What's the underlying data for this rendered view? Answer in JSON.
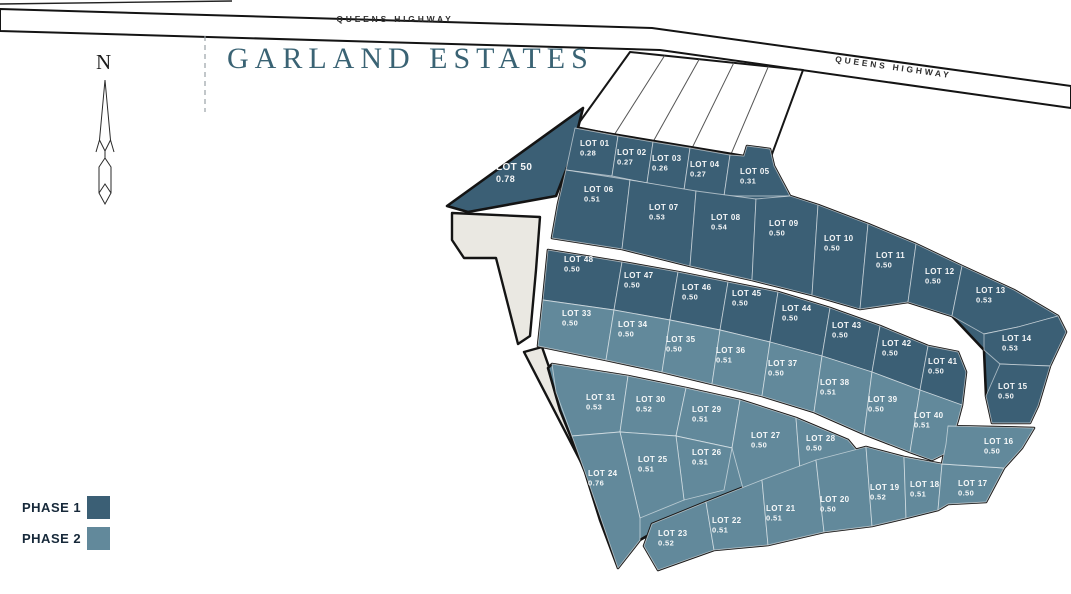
{
  "page": {
    "title": "GARLAND ESTATES"
  },
  "highway": {
    "name": "QUEENS HIGHWAY"
  },
  "compass": {
    "north_label": "N"
  },
  "legend": {
    "items": [
      {
        "label": "PHASE 1",
        "color": "#3B5F75"
      },
      {
        "label": "PHASE 2",
        "color": "#62899B"
      }
    ]
  },
  "map": {
    "colors": {
      "phase1": "#3B5F75",
      "phase2": "#62899B",
      "parcel_beige": "#EAE8E2",
      "road_fill": "#FFFFFF",
      "outline": "#141414",
      "strip_divider": "#555555",
      "lot_divider": "rgba(255,255,255,0.55)",
      "label": "#FFFFFF",
      "dashed": "#9AA2A6",
      "highway_text": "#2E2E2E"
    },
    "road_band": "0,9 652,28 1071,86 1071,108 660,50 0,31",
    "top_line": {
      "x1": 0,
      "y1": 4,
      "x2": 232,
      "y2": 1
    },
    "dashed_line": {
      "x": 205,
      "y1": 36,
      "y2": 112
    },
    "strips": {
      "pts": "630,52 803,70 768,165 576,127",
      "dividers": 4
    },
    "beige_parcels": [
      "452,213 540,217 536,270 530,336 518,344 496,258 464,258 452,240",
      "524,352 542,347 585,470"
    ],
    "blocks": [
      {
        "name": "block-north",
        "phase": 1,
        "pts": "575,128 744,156 747,146 770,149 774,166 790,196 818,205 868,224 916,244 962,266 1014,290 1058,316 1066,332 1050,366 1038,406 1030,423 992,423 986,396 984,350 952,316 908,302 860,309 812,295 752,280 690,266 622,249 552,238 558,204 566,170"
      },
      {
        "name": "block-mid",
        "phase": 2,
        "pts": "548,250 622,262 678,272 728,282 778,292 830,308 880,326 928,346 958,352 966,372 962,405 958,420 948,452 932,460 910,452 864,434 814,412 762,396 712,384 662,372 606,360 538,346 543,300"
      },
      {
        "name": "block-southwest",
        "phase": 2,
        "pts": "552,364 628,376 686,388 740,400 796,418 848,440 858,452 800,472 744,494 690,516 654,532 640,540 618,568 600,520 585,472 560,410 548,368"
      },
      {
        "name": "block-south",
        "phase": 2,
        "pts": "652,524 706,502 762,480 816,460 866,447 904,457 942,464 946,444 948,426 1034,428 1022,448 1004,468 986,502 948,504 938,510 906,518 872,526 824,532 768,545 714,550 658,570 644,546"
      }
    ],
    "highway_labels": [
      {
        "x": 395,
        "y": 22,
        "rotate": 0
      },
      {
        "x": 893,
        "y": 70,
        "rotate": 8
      }
    ],
    "lots": [
      {
        "id": "50",
        "name": "LOT 50",
        "area": "0.78",
        "phase": 1,
        "big": true,
        "pts": "447,206 583,108 570,160 556,196 468,212",
        "lx": 496,
        "ly": 170
      },
      {
        "id": "01",
        "name": "LOT 01",
        "area": "0.28",
        "phase": 1,
        "pts": "575,128 618,136 612,176 566,170",
        "lx": 580,
        "ly": 146
      },
      {
        "id": "02",
        "name": "LOT 02",
        "area": "0.27",
        "phase": 1,
        "pts": "618,136 653,142 647,183 612,176",
        "lx": 617,
        "ly": 155
      },
      {
        "id": "03",
        "name": "LOT 03",
        "area": "0.26",
        "phase": 1,
        "pts": "653,142 690,148 684,190 647,183",
        "lx": 652,
        "ly": 161
      },
      {
        "id": "04",
        "name": "LOT 04",
        "area": "0.27",
        "phase": 1,
        "pts": "690,148 730,155 724,196 684,190",
        "lx": 690,
        "ly": 167
      },
      {
        "id": "05",
        "name": "LOT 05",
        "area": "0.31",
        "phase": 1,
        "pts": "730,155 744,156 747,146 770,149 774,166 790,196 724,196",
        "lx": 740,
        "ly": 174
      },
      {
        "id": "06",
        "name": "LOT 06",
        "area": "0.51",
        "phase": 1,
        "pts": "566,170 630,180 622,249 552,238 558,204",
        "lx": 584,
        "ly": 192
      },
      {
        "id": "07",
        "name": "LOT 07",
        "area": "0.53",
        "phase": 1,
        "pts": "630,180 696,191 690,266 622,249",
        "lx": 649,
        "ly": 210
      },
      {
        "id": "08",
        "name": "LOT 08",
        "area": "0.54",
        "phase": 1,
        "pts": "696,191 756,199 752,280 690,266",
        "lx": 711,
        "ly": 220
      },
      {
        "id": "09",
        "name": "LOT 09",
        "area": "0.50",
        "phase": 1,
        "pts": "756,199 790,196 818,205 812,295 752,280",
        "lx": 769,
        "ly": 226
      },
      {
        "id": "10",
        "name": "LOT 10",
        "area": "0.50",
        "phase": 1,
        "pts": "818,205 868,224 860,309 812,295",
        "lx": 824,
        "ly": 241
      },
      {
        "id": "11",
        "name": "LOT 11",
        "area": "0.50",
        "phase": 1,
        "pts": "868,224 916,244 908,302 860,309",
        "lx": 876,
        "ly": 258
      },
      {
        "id": "12",
        "name": "LOT 12",
        "area": "0.50",
        "phase": 1,
        "pts": "916,244 962,266 952,316 908,302",
        "lx": 925,
        "ly": 274
      },
      {
        "id": "13",
        "name": "LOT 13",
        "area": "0.53",
        "phase": 1,
        "pts": "962,266 1014,290 1058,316 1018,327 984,334 952,316",
        "lx": 976,
        "ly": 293
      },
      {
        "id": "14",
        "name": "LOT 14",
        "area": "0.53",
        "phase": 1,
        "pts": "984,334 1018,327 1058,316 1066,332 1050,366 1000,364 984,350",
        "lx": 1002,
        "ly": 341
      },
      {
        "id": "15",
        "name": "LOT 15",
        "area": "0.50",
        "phase": 1,
        "pts": "1000,364 1050,366 1038,406 1030,423 992,423 986,396",
        "lx": 998,
        "ly": 389
      },
      {
        "id": "48",
        "name": "LOT 48",
        "area": "0.50",
        "phase": 1,
        "pts": "548,250 622,262 614,310 543,300",
        "lx": 564,
        "ly": 262
      },
      {
        "id": "47",
        "name": "LOT 47",
        "area": "0.50",
        "phase": 1,
        "pts": "622,262 678,272 670,320 614,310",
        "lx": 624,
        "ly": 278
      },
      {
        "id": "46",
        "name": "LOT 46",
        "area": "0.50",
        "phase": 1,
        "pts": "678,272 728,282 720,330 670,320",
        "lx": 682,
        "ly": 290
      },
      {
        "id": "45",
        "name": "LOT 45",
        "area": "0.50",
        "phase": 1,
        "pts": "728,282 778,292 770,342 720,330",
        "lx": 732,
        "ly": 296
      },
      {
        "id": "44",
        "name": "LOT 44",
        "area": "0.50",
        "phase": 1,
        "pts": "778,292 830,308 822,356 770,342",
        "lx": 782,
        "ly": 311
      },
      {
        "id": "43",
        "name": "LOT 43",
        "area": "0.50",
        "phase": 1,
        "pts": "830,308 880,326 872,372 822,356",
        "lx": 832,
        "ly": 328
      },
      {
        "id": "42",
        "name": "LOT 42",
        "area": "0.50",
        "phase": 1,
        "pts": "880,326 928,346 920,390 872,372",
        "lx": 882,
        "ly": 346
      },
      {
        "id": "41",
        "name": "LOT 41",
        "area": "0.50",
        "phase": 1,
        "pts": "928,346 958,352 966,372 962,405 920,390",
        "lx": 928,
        "ly": 364
      },
      {
        "id": "33",
        "name": "LOT 33",
        "area": "0.50",
        "phase": 2,
        "pts": "543,300 614,310 606,360 538,346",
        "lx": 562,
        "ly": 316
      },
      {
        "id": "34",
        "name": "LOT 34",
        "area": "0.50",
        "phase": 2,
        "pts": "614,310 670,320 662,372 606,360",
        "lx": 618,
        "ly": 327
      },
      {
        "id": "35",
        "name": "LOT 35",
        "area": "0.50",
        "phase": 2,
        "pts": "670,320 720,330 712,384 662,372",
        "lx": 666,
        "ly": 342
      },
      {
        "id": "36",
        "name": "LOT 36",
        "area": "0.51",
        "phase": 2,
        "pts": "720,330 770,342 762,396 712,384",
        "lx": 716,
        "ly": 353
      },
      {
        "id": "37",
        "name": "LOT 37",
        "area": "0.50",
        "phase": 2,
        "pts": "770,342 822,356 814,412 762,396",
        "lx": 768,
        "ly": 366
      },
      {
        "id": "38",
        "name": "LOT 38",
        "area": "0.51",
        "phase": 2,
        "pts": "822,356 872,372 864,434 814,412",
        "lx": 820,
        "ly": 385
      },
      {
        "id": "39",
        "name": "LOT 39",
        "area": "0.50",
        "phase": 2,
        "pts": "872,372 920,390 910,452 864,434",
        "lx": 868,
        "ly": 402
      },
      {
        "id": "40",
        "name": "LOT 40",
        "area": "0.51",
        "phase": 2,
        "pts": "920,390 962,405 958,420 948,452 932,460 910,452",
        "lx": 914,
        "ly": 418
      },
      {
        "id": "31",
        "name": "LOT 31",
        "area": "0.53",
        "phase": 2,
        "pts": "552,364 628,376 620,432 572,436 556,392",
        "lx": 586,
        "ly": 400
      },
      {
        "id": "30",
        "name": "LOT 30",
        "area": "0.52",
        "phase": 2,
        "pts": "628,376 686,388 676,436 620,432",
        "lx": 636,
        "ly": 402
      },
      {
        "id": "29",
        "name": "LOT 29",
        "area": "0.51",
        "phase": 2,
        "pts": "686,388 740,400 732,448 676,436",
        "lx": 692,
        "ly": 412
      },
      {
        "id": "27",
        "name": "LOT 27",
        "area": "0.50",
        "phase": 2,
        "pts": "740,400 796,418 800,470 744,492 732,448",
        "lx": 751,
        "ly": 438
      },
      {
        "id": "28",
        "name": "LOT 28",
        "area": "0.50",
        "phase": 2,
        "pts": "796,418 848,440 858,452 800,470",
        "lx": 806,
        "ly": 441
      },
      {
        "id": "26",
        "name": "LOT 26",
        "area": "0.51",
        "phase": 2,
        "pts": "676,436 732,448 724,490 684,500",
        "lx": 692,
        "ly": 455
      },
      {
        "id": "25",
        "name": "LOT 25",
        "area": "0.51",
        "phase": 2,
        "pts": "620,432 676,436 684,500 640,518",
        "lx": 638,
        "ly": 462
      },
      {
        "id": "24",
        "name": "LOT 24",
        "area": "0.76",
        "phase": 2,
        "pts": "572,436 620,432 640,518 640,540 618,568 585,472",
        "lx": 588,
        "ly": 476
      },
      {
        "id": "23",
        "name": "LOT 23",
        "area": "0.52",
        "phase": 2,
        "pts": "652,524 706,502 714,550 658,570 644,546",
        "lx": 658,
        "ly": 536
      },
      {
        "id": "22",
        "name": "LOT 22",
        "area": "0.51",
        "phase": 2,
        "pts": "706,502 762,480 768,545 714,550",
        "lx": 712,
        "ly": 523
      },
      {
        "id": "21",
        "name": "LOT 21",
        "area": "0.51",
        "phase": 2,
        "pts": "762,480 816,460 824,532 768,545",
        "lx": 766,
        "ly": 511
      },
      {
        "id": "20",
        "name": "LOT 20",
        "area": "0.50",
        "phase": 2,
        "pts": "816,460 866,447 872,526 824,532",
        "lx": 820,
        "ly": 502
      },
      {
        "id": "19",
        "name": "LOT 19",
        "area": "0.52",
        "phase": 2,
        "pts": "866,447 904,457 906,518 872,526",
        "lx": 870,
        "ly": 490
      },
      {
        "id": "18",
        "name": "LOT 18",
        "area": "0.51",
        "phase": 2,
        "pts": "904,457 942,464 938,510 906,518",
        "lx": 910,
        "ly": 487
      },
      {
        "id": "17",
        "name": "LOT 17",
        "area": "0.50",
        "phase": 2,
        "pts": "942,464 1004,468 986,502 948,504 938,510",
        "lx": 958,
        "ly": 486
      },
      {
        "id": "16",
        "name": "LOT 16",
        "area": "0.50",
        "phase": 2,
        "pts": "948,426 1034,428 1022,448 1004,468 942,464 946,444",
        "lx": 984,
        "ly": 444
      }
    ]
  }
}
